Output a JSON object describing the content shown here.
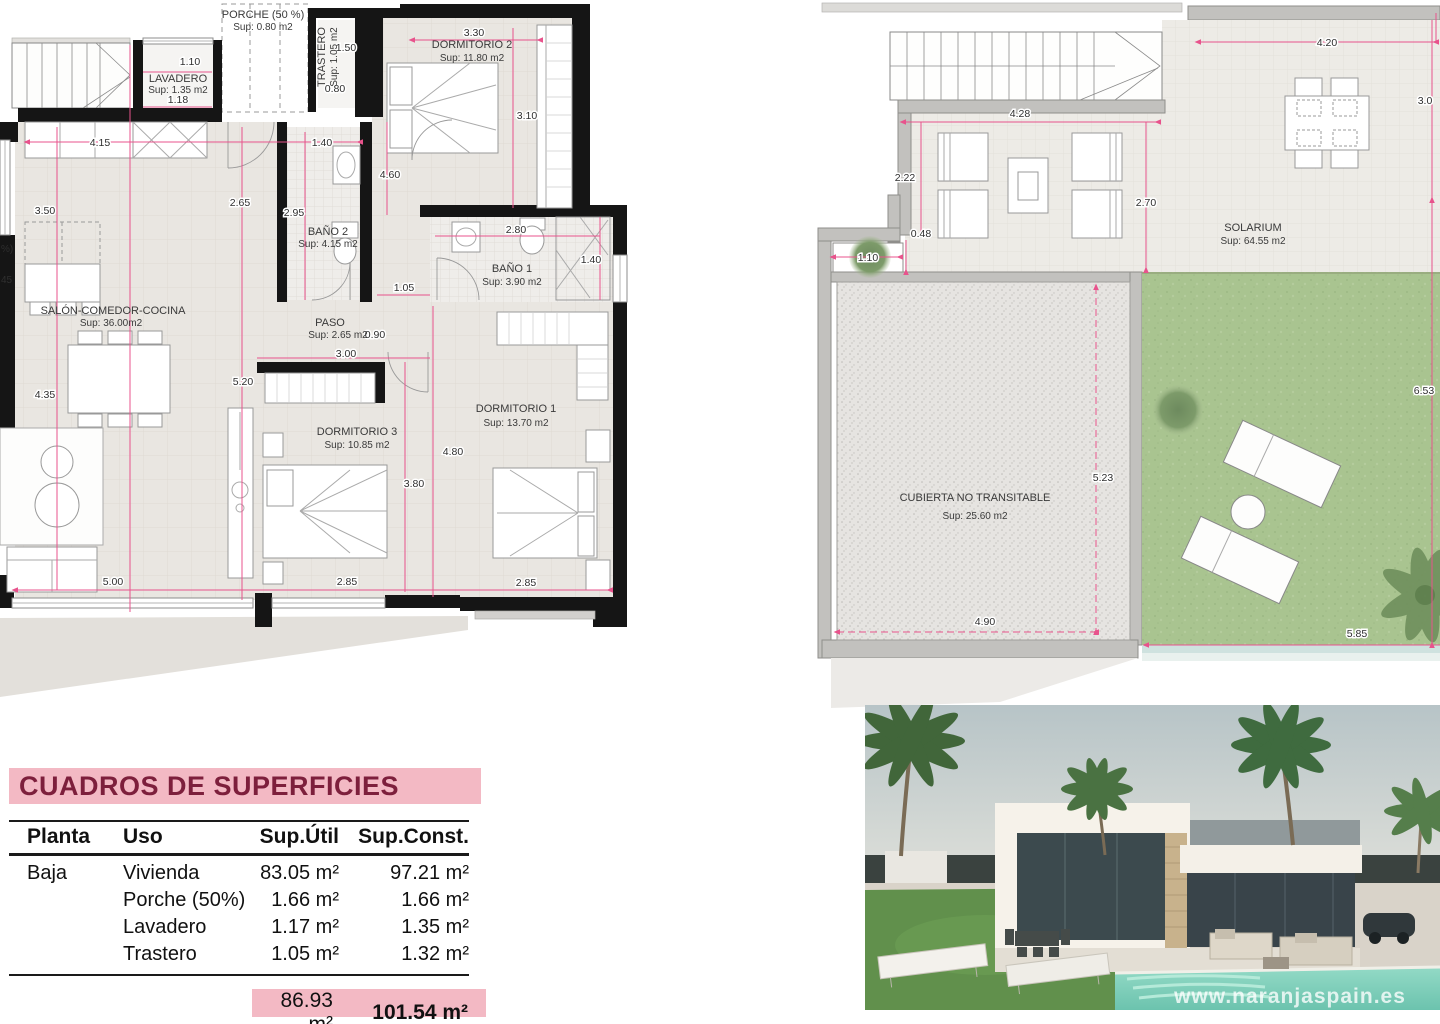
{
  "left_plan": {
    "rooms": {
      "lavadero": {
        "name": "LAVADERO",
        "sup": "Sup: 1.35 m2"
      },
      "porche": {
        "name": "PORCHE (50 %)",
        "sup": "Sup: 0.80 m2"
      },
      "trastero": {
        "name": "TRASTERO",
        "sup": "Sup: 1.05 m2"
      },
      "dormitorio2": {
        "name": "DORMITORIO 2",
        "sup": "Sup: 11.80 m2"
      },
      "bano2": {
        "name": "BAÑO 2",
        "sup": "Sup: 4.15 m2"
      },
      "bano1": {
        "name": "BAÑO 1",
        "sup": "Sup: 3.90 m2"
      },
      "salon": {
        "name": "SALÓN-COMEDOR-COCINA",
        "sup": "Sup: 36.00m2"
      },
      "paso": {
        "name": "PASO",
        "sup": "Sup: 2.65 m2"
      },
      "dormitorio3": {
        "name": "DORMITORIO 3",
        "sup": "Sup: 10.85 m2"
      },
      "dormitorio1": {
        "name": "DORMITORIO 1",
        "sup": "Sup: 13.70 m2"
      }
    },
    "dims": [
      "1.10",
      "1.18",
      "1.50",
      "0.80",
      "3.30",
      "3.10",
      "4.15",
      "1.40",
      "3.50",
      "2.65",
      "2.95",
      "4.60",
      "1.05",
      "2.80",
      "1.40",
      "0.90",
      "3.00",
      "5.20",
      "4.35",
      "4.80",
      "3.80",
      "5.00",
      "2.85",
      "2.85"
    ],
    "edge_fragments": [
      "%)",
      "45"
    ]
  },
  "right_plan": {
    "solarium": {
      "name": "SOLARIUM",
      "sup": "Sup: 64.55 m2"
    },
    "cubierta": {
      "name": "CUBIERTA NO TRANSITABLE",
      "sup": "Sup: 25.60 m2"
    },
    "dims": [
      "4.20",
      "4.28",
      "2.22",
      "0.48",
      "1.10",
      "2.70",
      "3.0",
      "5.23",
      "4.90",
      "5.85",
      "6.53"
    ]
  },
  "surface_table": {
    "title": "CUADROS DE SUPERFICIES",
    "headers": [
      "Planta",
      "Uso",
      "Sup.Útil",
      "Sup.Const."
    ],
    "rows": [
      {
        "planta": "Baja",
        "uso": "Vivienda",
        "util": "83.05 m²",
        "const": "97.21 m²"
      },
      {
        "planta": "",
        "uso": "Porche (50%)",
        "util": "1.66 m²",
        "const": "1.66 m²"
      },
      {
        "planta": "",
        "uso": "Lavadero",
        "util": "1.17 m²",
        "const": "1.35 m²"
      },
      {
        "planta": "",
        "uso": "Trastero",
        "util": "1.05 m²",
        "const": "1.32 m²"
      }
    ],
    "totals": {
      "util": "86.93 m²",
      "const": "101.54 m²"
    }
  },
  "photo": {
    "watermark": "www.naranjaspain.es"
  },
  "colors": {
    "dimension_pink": "#e8538c",
    "wall_black": "#151515",
    "plan_floor": "#e9e6e1",
    "outer_wall_gray": "#c2c1be",
    "grass_green": "#a9c490",
    "pool_turquoise": "#83d2be",
    "table_pink": "#f3b9c4",
    "table_title_text": "#7d1f3c"
  }
}
